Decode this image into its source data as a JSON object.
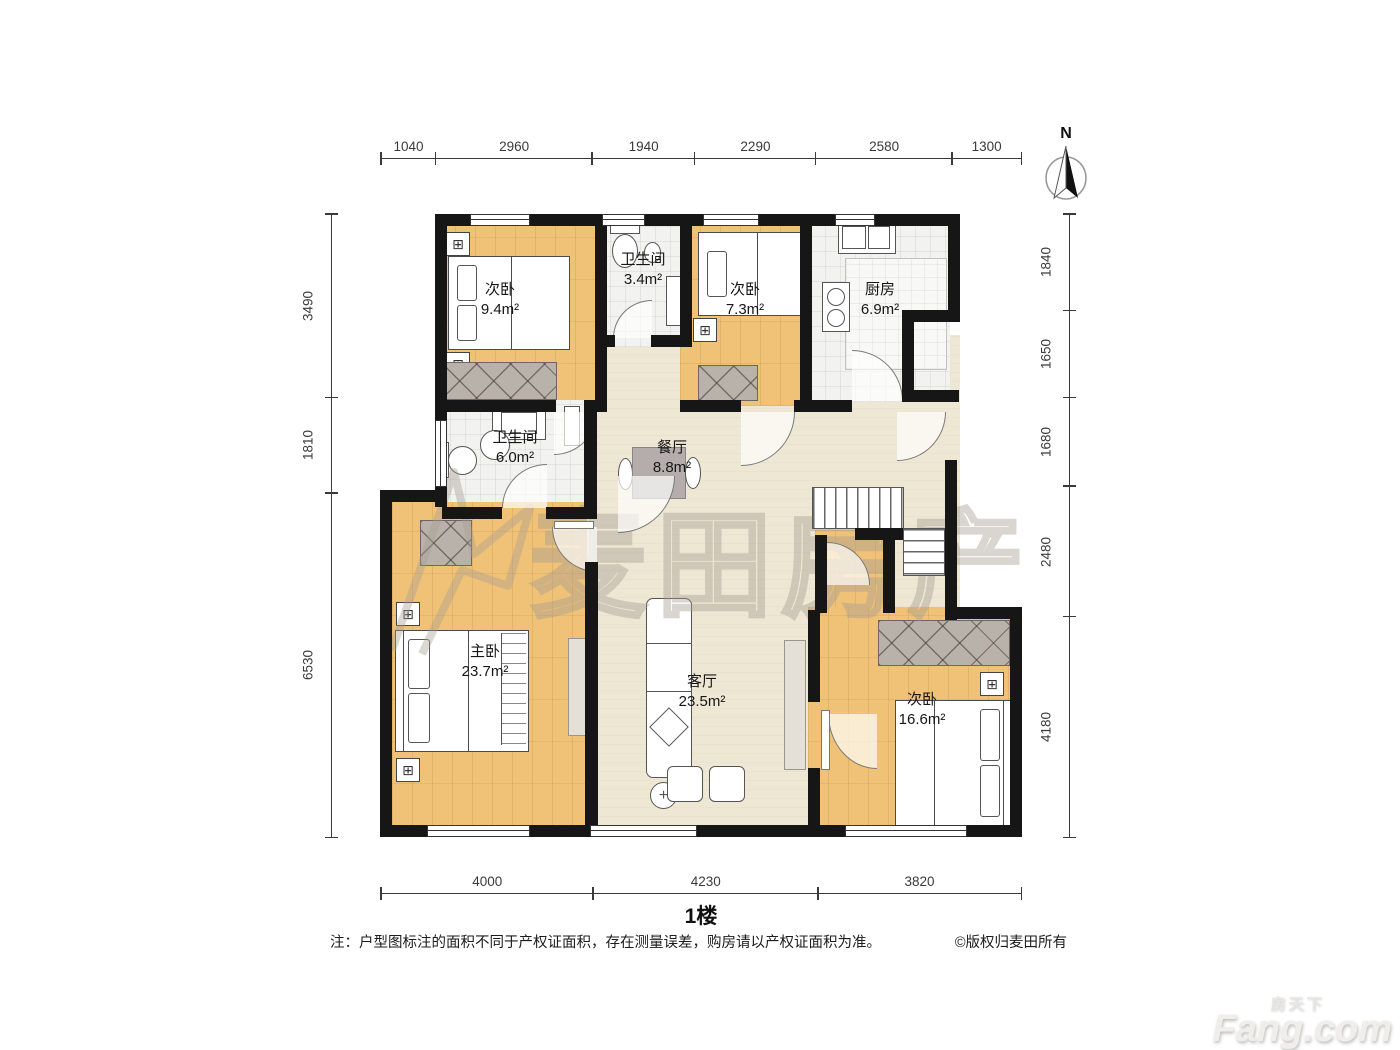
{
  "meta": {
    "floor_title": "1楼",
    "note": "注：户型图标注的面积不同于产权证面积，存在测量误差，购房请以产权证面积为准。",
    "copyright": "©版权归麦田所有",
    "compass_label": "N"
  },
  "watermark": {
    "brand": "麦田房产",
    "site_cn": "房天下",
    "site_en": "Fang.com"
  },
  "dimensions": {
    "top": [
      1040,
      2960,
      1940,
      2290,
      2580,
      1300
    ],
    "bottom": [
      4000,
      4230,
      3820
    ],
    "left": [
      3490,
      1810,
      6530
    ],
    "right": [
      1840,
      1650,
      1680,
      2480,
      4180
    ]
  },
  "rooms": [
    {
      "id": "bedroom-nw",
      "name": "次卧",
      "area": "9.4m²"
    },
    {
      "id": "bath-n",
      "name": "卫生间",
      "area": "3.4m²"
    },
    {
      "id": "bedroom-n",
      "name": "次卧",
      "area": "7.3m²"
    },
    {
      "id": "kitchen",
      "name": "厨房",
      "area": "6.9m²"
    },
    {
      "id": "bath-w",
      "name": "卫生间",
      "area": "6.0m²"
    },
    {
      "id": "dining",
      "name": "餐厅",
      "area": "8.8m²"
    },
    {
      "id": "master",
      "name": "主卧",
      "area": "23.7m²"
    },
    {
      "id": "living",
      "name": "客厅",
      "area": "23.5m²"
    },
    {
      "id": "bedroom-se",
      "name": "次卧",
      "area": "16.6m²"
    }
  ],
  "colors": {
    "wall": "#161616",
    "wood_floor": "#f0c277",
    "tile_floor": "#f2f2f0",
    "hall_floor": "#eee7d4",
    "wardrobe": "#b9b2ab",
    "watermark": "#a59d92",
    "dim_text": "#3a3a3a"
  }
}
